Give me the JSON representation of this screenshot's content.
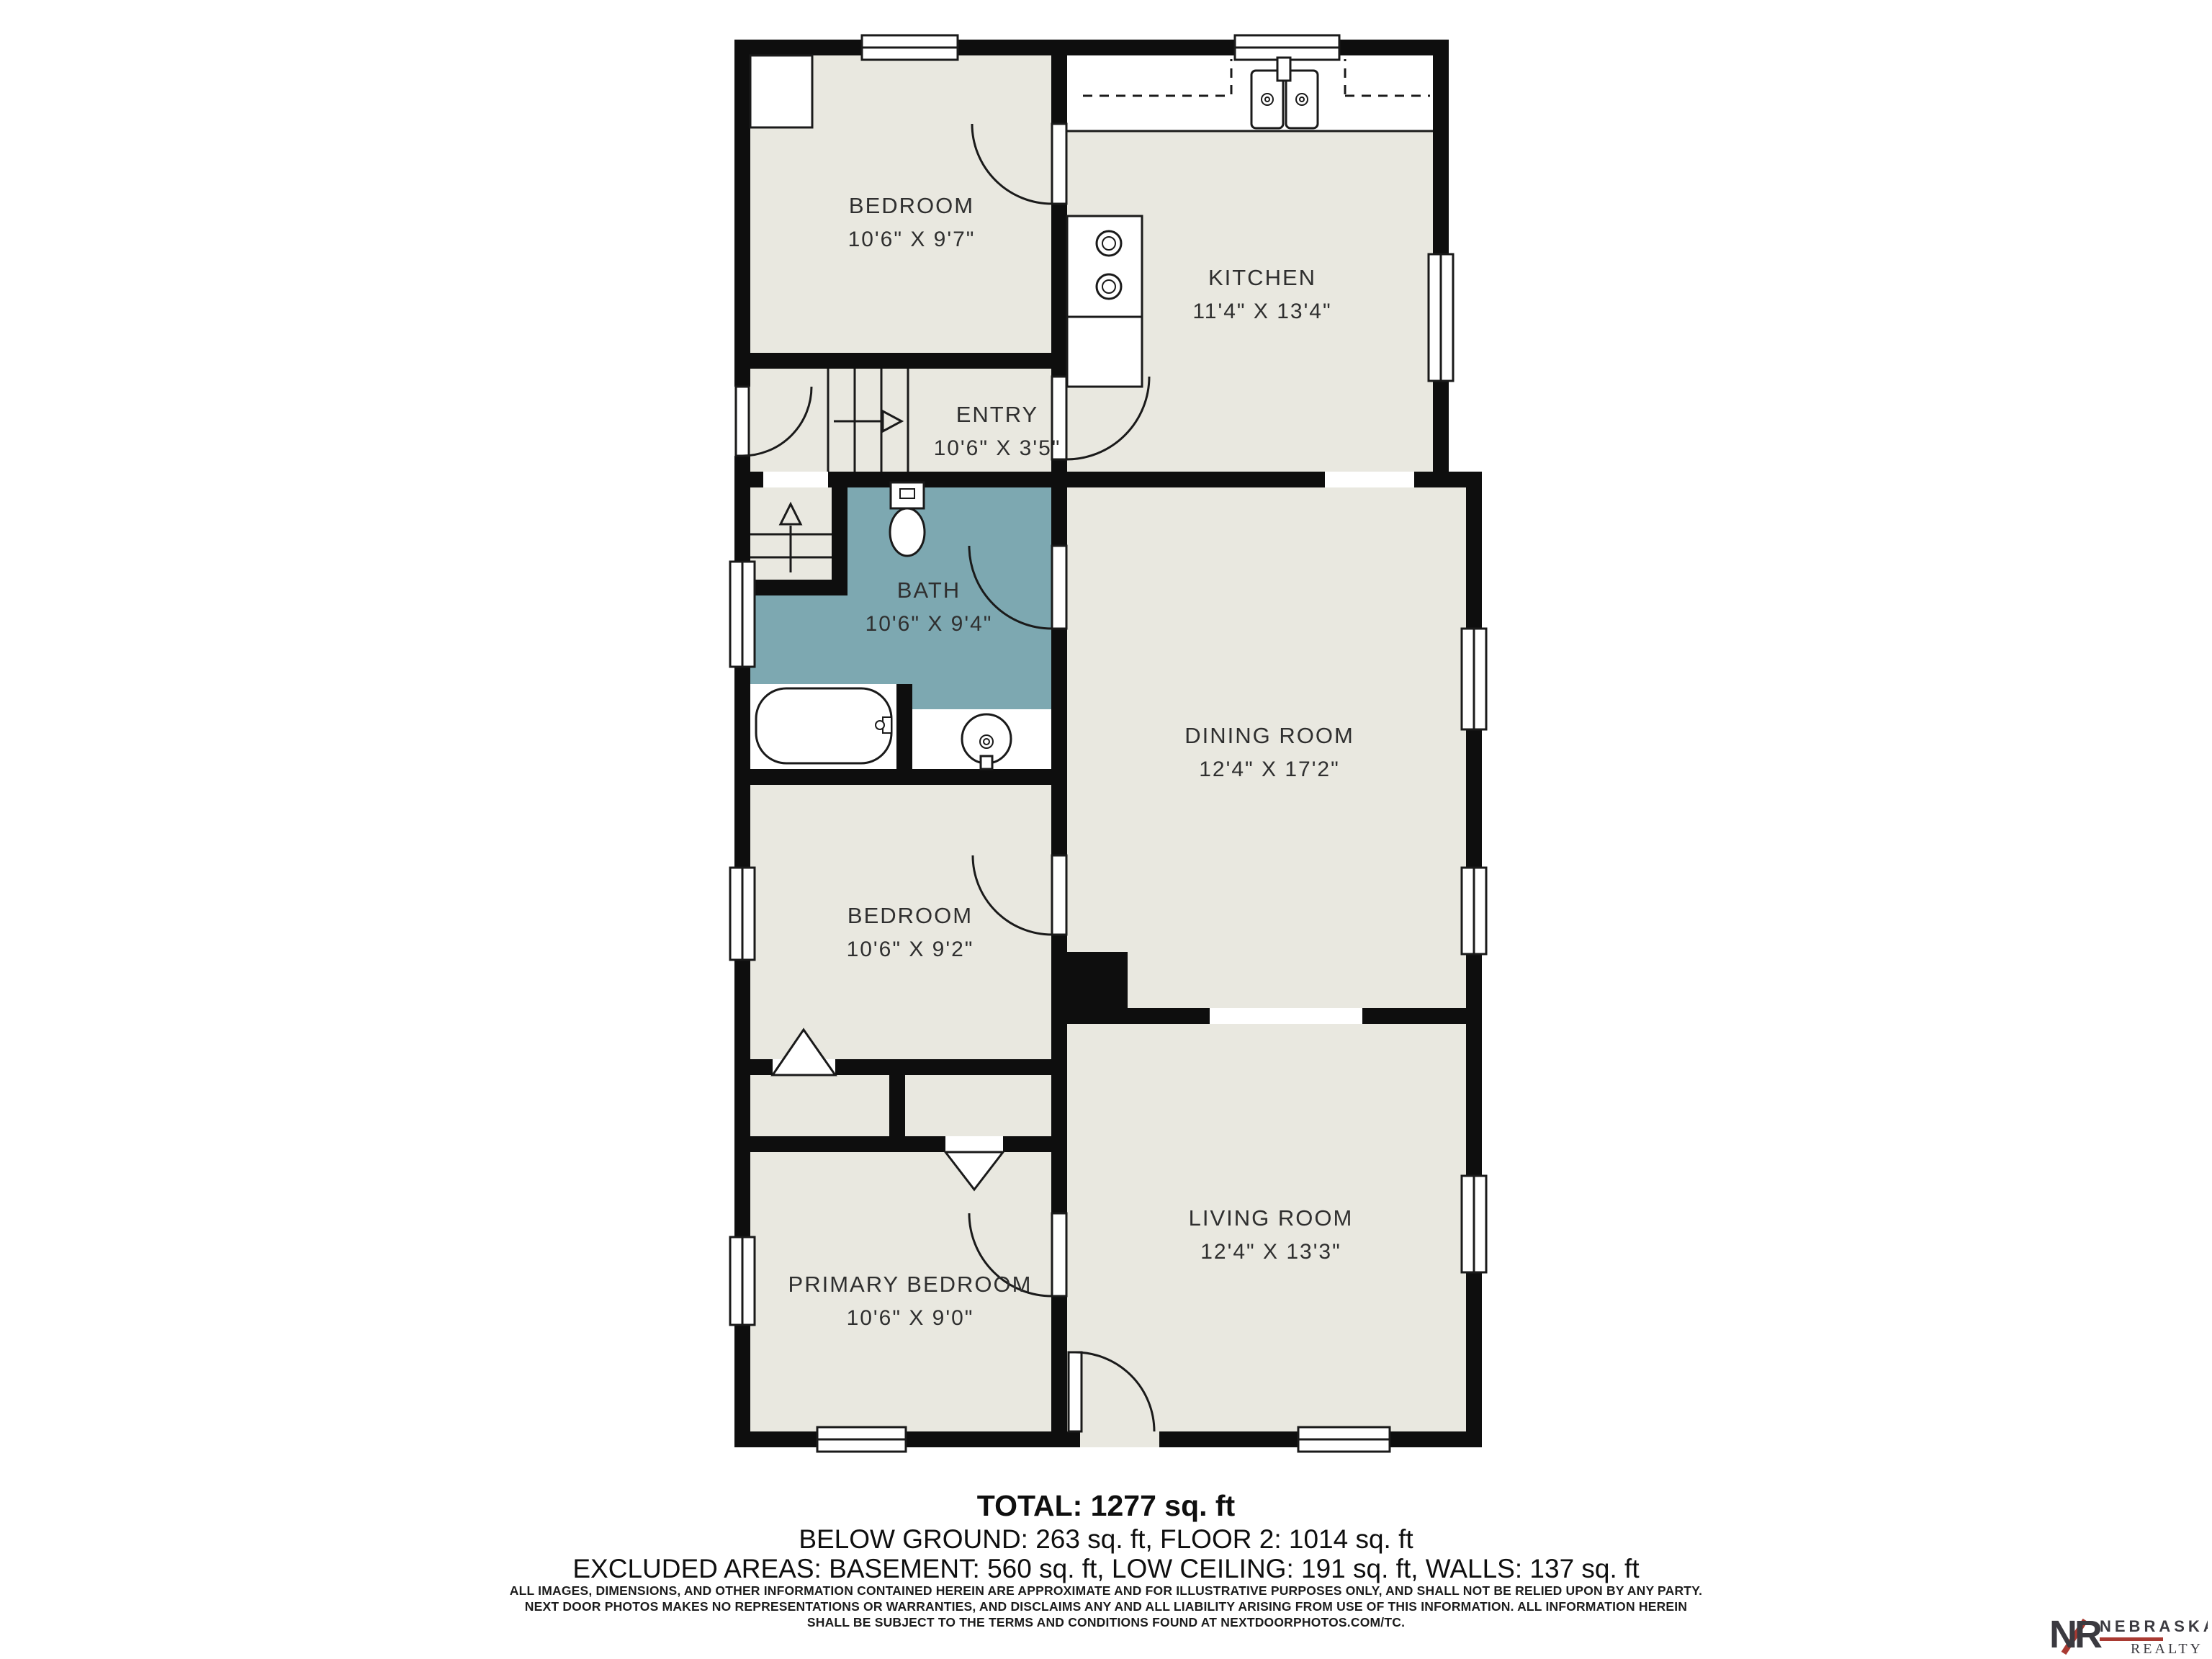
{
  "colors": {
    "floor": "#e9e8e0",
    "bath": "#7da8b1",
    "wall": "#0e0e0e",
    "line": "#1a1a1a",
    "label": "#2f2f2f",
    "logo_dark": "#3b3a40",
    "logo_red": "#a93a32"
  },
  "plan": {
    "rooms": [
      {
        "name": "BEDROOM",
        "dims": "10'6\" X 9'7\""
      },
      {
        "name": "KITCHEN",
        "dims": "11'4\" X 13'4\""
      },
      {
        "name": "ENTRY",
        "dims": "10'6\" X 3'5\""
      },
      {
        "name": "BATH",
        "dims": "10'6\" X 9'4\""
      },
      {
        "name": "DINING ROOM",
        "dims": "12'4\" X 17'2\""
      },
      {
        "name": "BEDROOM",
        "dims": "10'6\" X 9'2\""
      },
      {
        "name": "PRIMARY BEDROOM",
        "dims": "10'6\" X 9'0\""
      },
      {
        "name": "LIVING ROOM",
        "dims": "12'4\" X 13'3\""
      }
    ]
  },
  "summary": {
    "total": "TOTAL: 1277 sq. ft",
    "line2": "BELOW GROUND: 263 sq. ft, FLOOR 2: 1014 sq. ft",
    "line3": "EXCLUDED AREAS: BASEMENT: 560 sq. ft, LOW CEILING: 191 sq. ft, WALLS: 137 sq. ft"
  },
  "disclaimer": {
    "line1": "ALL IMAGES, DIMENSIONS, AND OTHER INFORMATION CONTAINED HEREIN ARE APPROXIMATE AND FOR ILLUSTRATIVE PURPOSES ONLY, AND SHALL NOT BE RELIED UPON BY ANY PARTY.",
    "line2": "NEXT DOOR PHOTOS MAKES NO REPRESENTATIONS OR WARRANTIES, AND DISCLAIMS ANY AND ALL LIABILITY ARISING FROM USE OF THIS INFORMATION. ALL INFORMATION HEREIN",
    "line3": "SHALL BE SUBJECT TO THE TERMS AND CONDITIONS FOUND AT NEXTDOORPHOTOS.COM/TC."
  },
  "logo": {
    "monogram": "NR",
    "name": "NEBRASKA",
    "subname": "REALTY"
  }
}
